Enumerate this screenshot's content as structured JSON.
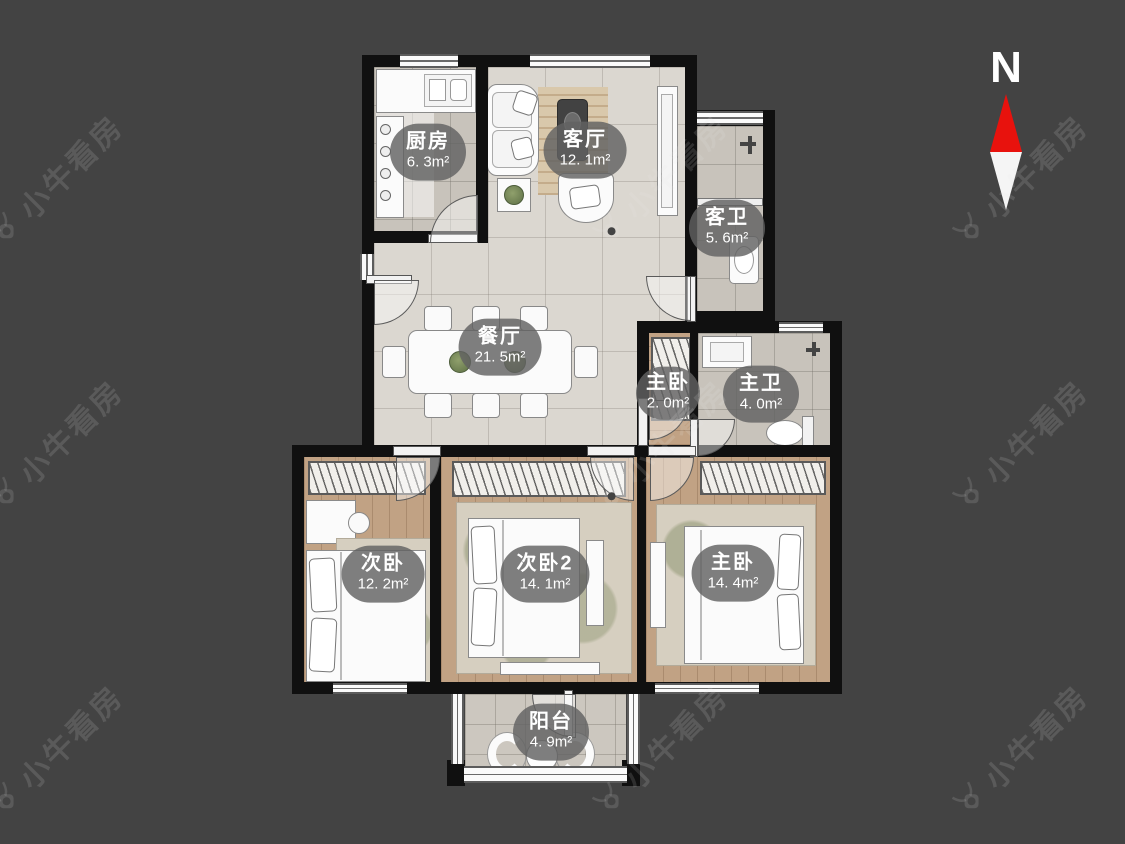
{
  "page": {
    "background_color": "#434343"
  },
  "compass": {
    "label": "N",
    "north_color": "#e8120d",
    "south_color": "#f5f5f5"
  },
  "watermark": {
    "text": "小牛看房"
  },
  "palette": {
    "wall": "#101010",
    "marble_floor": "#dbd7d0",
    "tile_floor": "#c8c3bb",
    "wood_floor": "#c1a284",
    "label_bubble": "#626262",
    "label_text": "#ffffff"
  },
  "rooms": [
    {
      "id": "kitchen",
      "name": "厨房",
      "area": "6. 3m²"
    },
    {
      "id": "living-room",
      "name": "客厅",
      "area": "12. 1m²"
    },
    {
      "id": "guest-bathroom",
      "name": "客卫",
      "area": "5. 6m²"
    },
    {
      "id": "dining-room",
      "name": "餐厅",
      "area": "21. 5m²"
    },
    {
      "id": "master-closet",
      "name": "主卧",
      "area": "2. 0m²"
    },
    {
      "id": "master-bathroom",
      "name": "主卫",
      "area": "4. 0m²"
    },
    {
      "id": "bedroom-2",
      "name": "次卧",
      "area": "12. 2m²"
    },
    {
      "id": "bedroom-3",
      "name": "次卧2",
      "area": "14. 1m²"
    },
    {
      "id": "master-bedroom",
      "name": "主卧",
      "area": "14. 4m²"
    },
    {
      "id": "balcony",
      "name": "阳台",
      "area": "4. 9m²"
    }
  ]
}
